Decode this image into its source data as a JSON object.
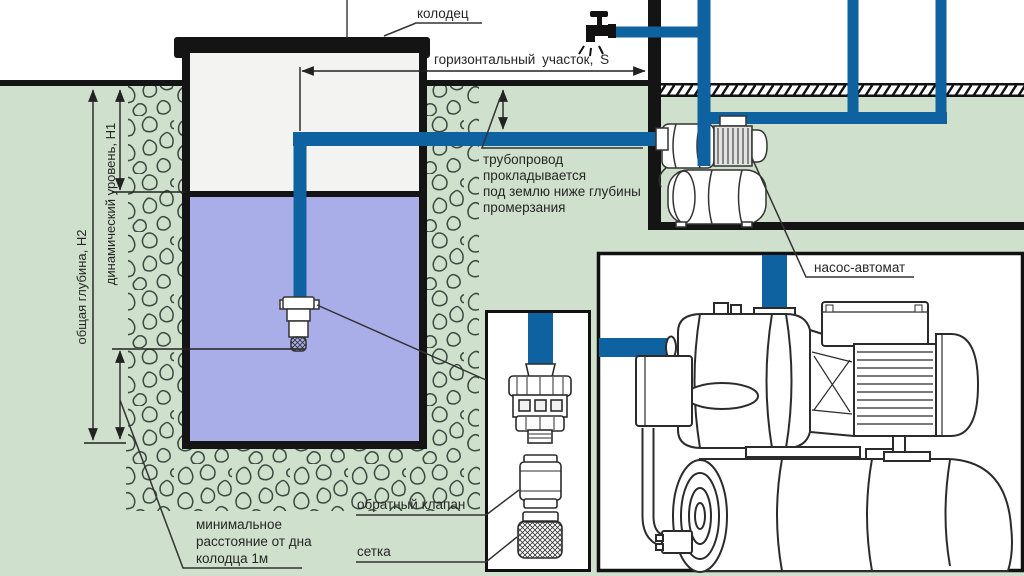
{
  "diagram": {
    "labels": {
      "well": "колодец",
      "horizontal_section": "горизонтальный участок,  S",
      "pipeline_note_lines": [
        "трубопровод",
        "прокладывается",
        "под землю ниже глубины",
        "промерзания"
      ],
      "pump_station": "насос-автомат",
      "check_valve": "обратный клапан",
      "strainer": "сетка",
      "min_distance_lines": [
        "минимальное",
        "расстояние от дна",
        "колодца 1м"
      ],
      "total_depth": "общая глубина, Н2",
      "dynamic_level": "динамический уровень, Н1"
    },
    "colors": {
      "pipe_blue": "#0f62a0",
      "water": "#a9aee9",
      "soil_green": "#cfe0cc",
      "well_interior": "#f3f3f1",
      "line_black": "#141414",
      "stone_outline": "#3c4b42"
    }
  }
}
